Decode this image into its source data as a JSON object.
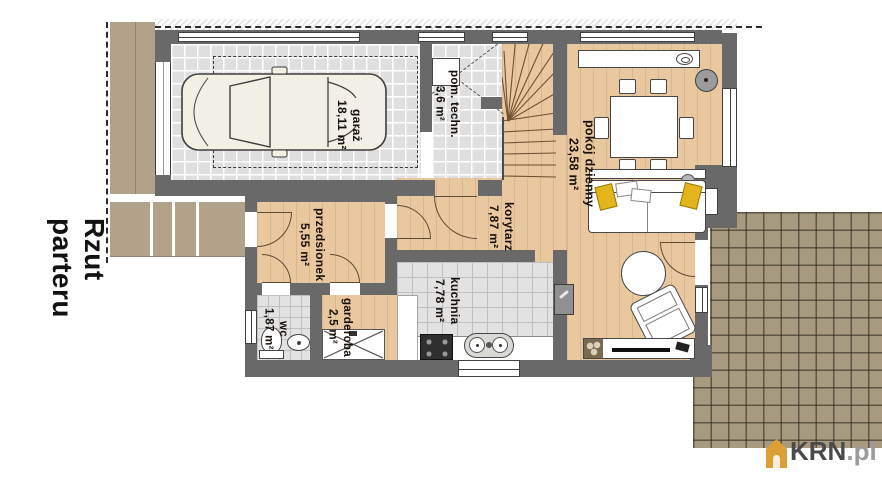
{
  "title": "Rzut parteru",
  "rooms": [
    {
      "name": "garaż",
      "area": "18,11 m²"
    },
    {
      "name": "pom. techn.",
      "area": "3,6 m²"
    },
    {
      "name": "pokój dzienny",
      "area": "23,58 m²"
    },
    {
      "name": "korytarz",
      "area": "7,87 m²"
    },
    {
      "name": "przedsionek",
      "area": "5,55 m²"
    },
    {
      "name": "wc",
      "area": "1,87 m²"
    },
    {
      "name": "garderoba",
      "area": "2,5 m²"
    },
    {
      "name": "kuchnia",
      "area": "7,78 m²"
    }
  ],
  "watermark": {
    "brand": "KRN",
    "suffix": ".pl"
  },
  "colors": {
    "wall": "#696969",
    "wood_floor": "#e9c89f",
    "tile_floor": "#dfdfdf",
    "paving": "#b2a28a",
    "terrace": "#a79a7e",
    "pillow_accent": "#e3b41c",
    "watermark_icon": "#dd9e35"
  }
}
